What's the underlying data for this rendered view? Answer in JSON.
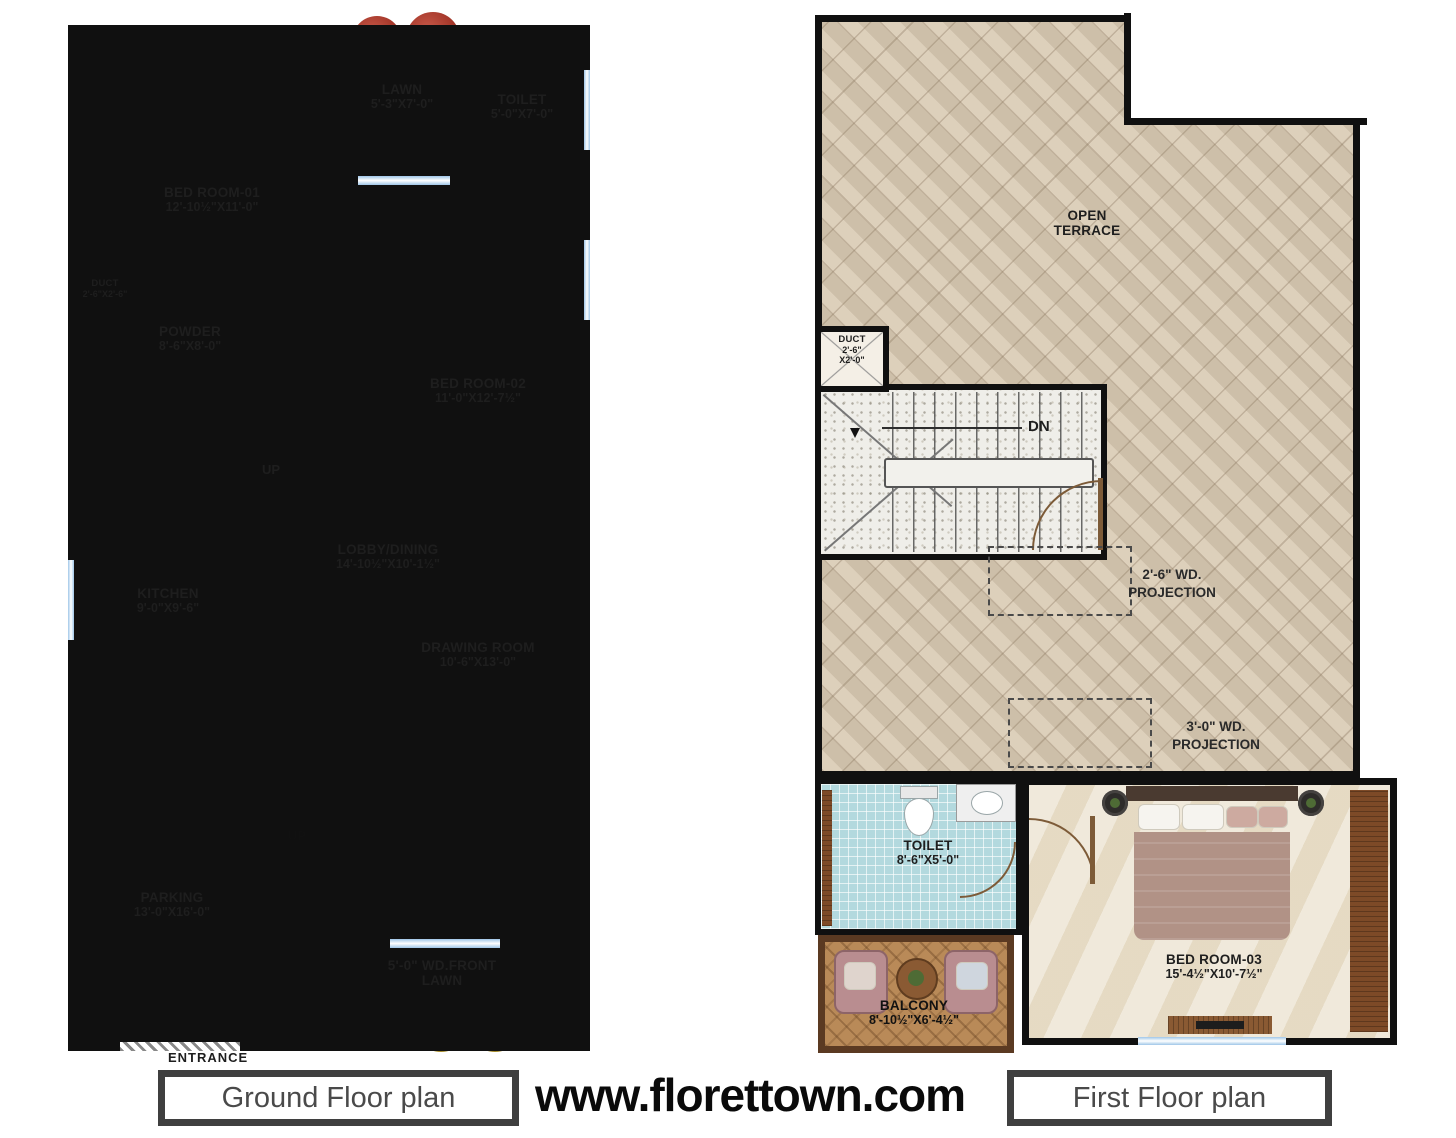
{
  "footer": {
    "ground_plan_label": "Ground Floor plan",
    "website": "www.florettown.com",
    "first_plan_label": "First Floor plan"
  },
  "colors": {
    "wall": "#101010",
    "bathroom_tile_blue": "#b3d9de",
    "lawn_green": "#4f9140",
    "terrace_tan": "#d8c9b2",
    "floor_beige": "#eae0cc",
    "wood_brown": "#7d4a27",
    "footer_border": "#3f3f3f"
  },
  "ground_floor": {
    "bed1": {
      "name": "BED ROOM-01",
      "dims": "12'-10½\"X11'-0\""
    },
    "lawn": {
      "name": "LAWN",
      "dims": "5'-3\"X7'-0\""
    },
    "toilet": {
      "name": "TOILET",
      "dims": "5'-0\"X7'-0\""
    },
    "duct": {
      "name": "DUCT",
      "dims": "2'-6\"X2'-6\""
    },
    "powder": {
      "name": "POWDER",
      "dims": "8'-6\"X8'-0\""
    },
    "bed2": {
      "name": "BED ROOM-02",
      "dims": "11'-0\"X12'-7½\""
    },
    "kitchen": {
      "name": "KITCHEN",
      "dims": "9'-0\"X9'-6\""
    },
    "freeze_label": "freeze",
    "lobby": {
      "name": "LOBBY/DINING",
      "dims": "14'-10½\"X10'-1½\""
    },
    "drawing": {
      "name": "DRAWING ROOM",
      "dims": "10'-6\"X13'-0\""
    },
    "parking": {
      "name": "PARKING",
      "dims": "13'-0\"X16'-0\""
    },
    "front_lawn": {
      "line1": "5'-0\" WD.FRONT",
      "line2": "LAWN"
    },
    "up1": "UP",
    "up2": "UP",
    "entrance": "ENTRANCE"
  },
  "first_floor": {
    "terrace": {
      "line1": "OPEN",
      "line2": "TERRACE"
    },
    "duct": {
      "name": "DUCT",
      "dims1": "2'-6\"",
      "dims2": "X2'-0\""
    },
    "dn": "DN",
    "projection1": {
      "line1": "2'-6\" WD.",
      "line2": "PROJECTION"
    },
    "projection2": {
      "line1": "3'-0\" WD.",
      "line2": "PROJECTION"
    },
    "toilet": {
      "name": "TOILET",
      "dims": "8'-6\"X5'-0\""
    },
    "balcony": {
      "name": "BALCONY",
      "dims": "8'-10½\"X6'-4½\""
    },
    "bed3": {
      "name": "BED ROOM-03",
      "dims": "15'-4½\"X10'-7½\""
    }
  }
}
